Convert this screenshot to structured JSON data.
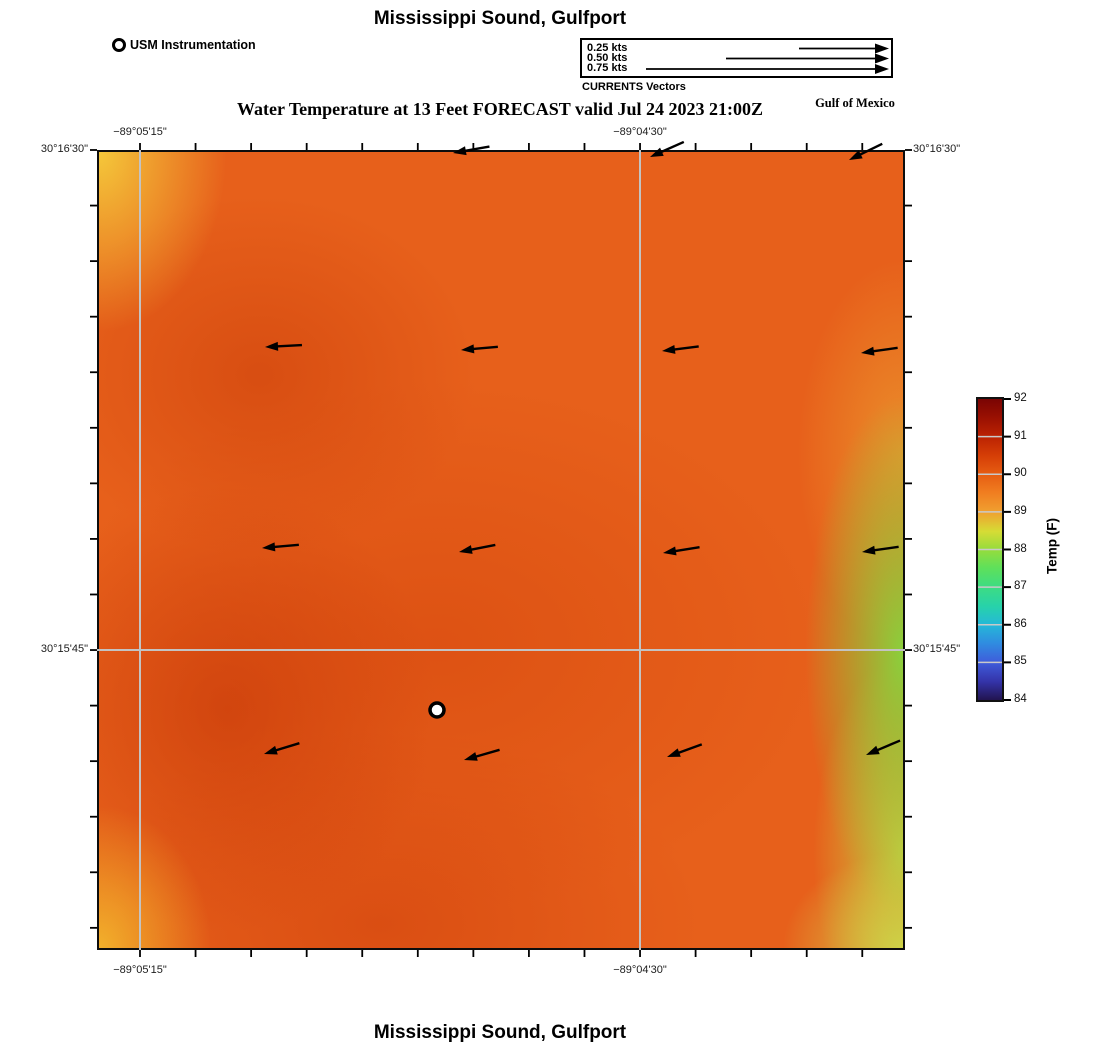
{
  "header": {
    "title": "Mississippi Sound, Gulfport",
    "subtitle": "Water Temperature at 13 Feet FORECAST valid Jul 24 2023 21:00Z",
    "region_label": "Gulf of Mexico"
  },
  "footer": {
    "title": "Mississippi Sound, Gulfport"
  },
  "station_legend": {
    "label": "USM Instrumentation",
    "marker": "white circle with black outline"
  },
  "currents_legend": {
    "caption": "CURRENTS Vectors",
    "speeds": [
      {
        "label": "0.25 kts"
      },
      {
        "label": "0.50 kts"
      },
      {
        "label": "0.75 kts"
      }
    ]
  },
  "axes": {
    "lon_top_1": "−89°05'15\"",
    "lon_top_2": "−89°04'30\"",
    "lon_bottom_1": "−89°05'15\"",
    "lon_bottom_2": "−89°04'30\"",
    "lat_left_1": "30°16'30\"",
    "lat_left_2": "30°15'45\"",
    "lat_right_1": "30°16'30\"",
    "lat_right_2": "30°15'45\""
  },
  "colorbar": {
    "label": "Temp (F)",
    "min": 84,
    "max": 92,
    "ticks": [
      92,
      91,
      90,
      89,
      88,
      87,
      86,
      85,
      84
    ]
  },
  "chart_data": {
    "type": "heatmap",
    "title": "Mississippi Sound, Gulfport",
    "subtitle": "Water Temperature at 13 Feet FORECAST valid Jul 24 2023 21:00Z",
    "x_tick_labels": [
      "−89°05'15\"",
      "−89°04'30\""
    ],
    "y_tick_labels": [
      "30°16'30\"",
      "30°15'45\""
    ],
    "colorbar": {
      "label": "Temp (F)",
      "min": 84,
      "max": 92,
      "ticks": [
        84,
        85,
        86,
        87,
        88,
        89,
        90,
        91,
        92
      ]
    },
    "temperature_grid_f": {
      "description": "Approximate water temperature (F) on a 5x5 sample grid, rows north to south, columns west to east",
      "values": [
        [
          89.3,
          90.6,
          90.6,
          90.5,
          90.4
        ],
        [
          90.9,
          91.1,
          90.8,
          90.6,
          89.6
        ],
        [
          91.1,
          91.0,
          90.8,
          90.4,
          88.4
        ],
        [
          91.3,
          91.1,
          90.9,
          90.1,
          88.3
        ],
        [
          89.9,
          91.0,
          90.8,
          90.3,
          88.9
        ]
      ]
    },
    "current_vectors": {
      "legend_speeds_kts": [
        0.25,
        0.5,
        0.75
      ],
      "approx_field_speed_kts": 0.15,
      "direction": "westward, tilting southwestward in northern and southern rows",
      "arrow_grid": "4 rows x 4 columns of black arrows pointing left"
    },
    "station_marker": {
      "name": "USM Instrumentation",
      "symbol": "white circle, black outline, near map center south of middle"
    },
    "grid": "light gray graticule lines at labeled lon/lat"
  },
  "render": {
    "map": {
      "left": 97,
      "top": 150,
      "width": 808,
      "height": 800
    },
    "grid_x": [
      140,
      640
    ],
    "grid_y": [
      650
    ],
    "tick_x0": 140,
    "tick_y0": 150,
    "tick_step": 55.56,
    "tick_len": 7,
    "arrows": [
      {
        "x": 453,
        "y": 153,
        "r": -10
      },
      {
        "x": 650,
        "y": 157,
        "r": -24
      },
      {
        "x": 849,
        "y": 160,
        "r": -26
      },
      {
        "x": 265,
        "y": 347,
        "r": -3
      },
      {
        "x": 461,
        "y": 350,
        "r": -5
      },
      {
        "x": 662,
        "y": 351,
        "r": -7
      },
      {
        "x": 861,
        "y": 353,
        "r": -8
      },
      {
        "x": 262,
        "y": 548,
        "r": -5
      },
      {
        "x": 459,
        "y": 552,
        "r": -11
      },
      {
        "x": 663,
        "y": 553,
        "r": -9
      },
      {
        "x": 862,
        "y": 552,
        "r": -8
      },
      {
        "x": 264,
        "y": 754,
        "r": -17
      },
      {
        "x": 464,
        "y": 760,
        "r": -16
      },
      {
        "x": 667,
        "y": 757,
        "r": -20
      },
      {
        "x": 866,
        "y": 755,
        "r": -23
      }
    ],
    "marker": {
      "x": 437,
      "y": 710,
      "r": 7
    },
    "legend_arrows": {
      "tip_x": 889,
      "tails": [
        799,
        726,
        646
      ],
      "rows_y": [
        48.5,
        58.5,
        69
      ]
    },
    "colorbar": {
      "left": 978,
      "top": 399,
      "width": 24,
      "height": 301,
      "label_x": 1014
    }
  }
}
